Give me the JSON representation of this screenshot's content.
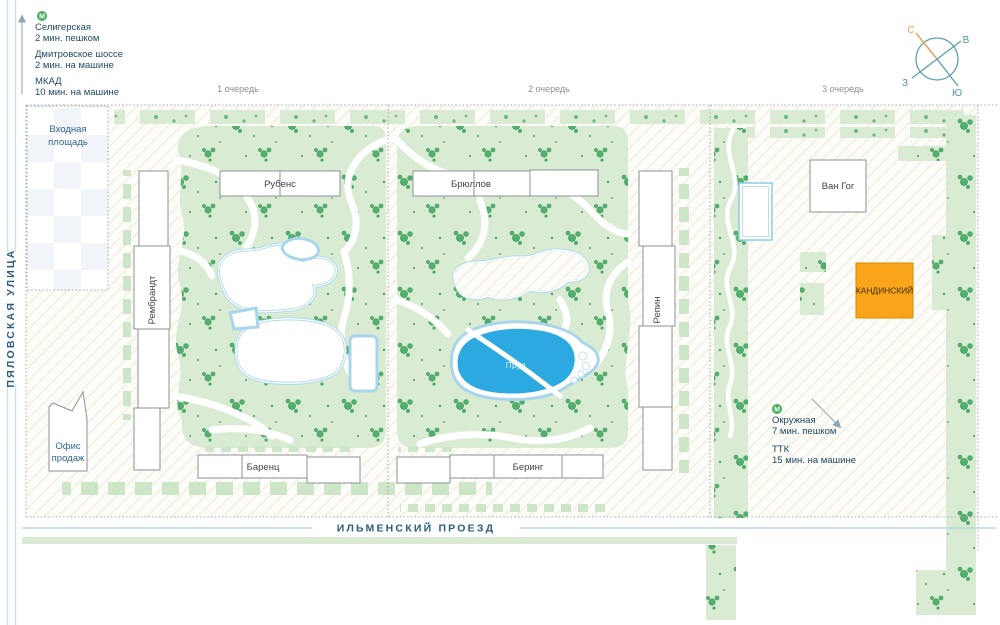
{
  "map": {
    "phases": [
      "1 очередь",
      "2 очередь",
      "3 очередь"
    ],
    "streets": {
      "left": "ПЯЛОВСКАЯ УЛИЦА",
      "bottom": "ИЛЬМЕНСКИЙ ПРОЕЗД"
    },
    "entrance_plaza": {
      "line1": "Входная",
      "line2": "площадь"
    },
    "sales_office": {
      "line1": "Офис",
      "line2": "продаж"
    },
    "pond_label": "Пруд",
    "buildings": {
      "rubens": "Рубенс",
      "bryullov": "Брюллов",
      "van_gogh": "Ван Гог",
      "kandinsky": "КАНДИНСКИЙ",
      "rembrandt": "Рембрандт",
      "repin": "Репин",
      "barents": "Баренц",
      "bering": "Беринг"
    }
  },
  "transit_top": {
    "items": [
      {
        "label": "Селигерская",
        "detail": "2 мин. пешком"
      },
      {
        "label": "Дмитровское шоссе",
        "detail": "2 мин. на машине"
      },
      {
        "label": "МКАД",
        "detail": "10 мин. на машине"
      }
    ]
  },
  "transit_right": {
    "items": [
      {
        "label": "Окружная",
        "detail": "7 мин. пешком"
      },
      {
        "label": "ТТК",
        "detail": "15 мин. на машине"
      }
    ]
  },
  "compass": {
    "north": "С",
    "east": "В",
    "south": "Ю",
    "west": "З"
  },
  "icons": {
    "metro_letter": "М"
  },
  "colors": {
    "accent_orange": "#F9A51B",
    "water_blue": "#2BA9E0",
    "park_green": "#D9EBD3",
    "tree_green": "#3BA15C",
    "label_blue": "#2F6690",
    "street_blue": "#2B5B7E",
    "metro_green": "#43AD5B",
    "compass_teal": "#4E93A8",
    "compass_orange": "#E8A353"
  }
}
